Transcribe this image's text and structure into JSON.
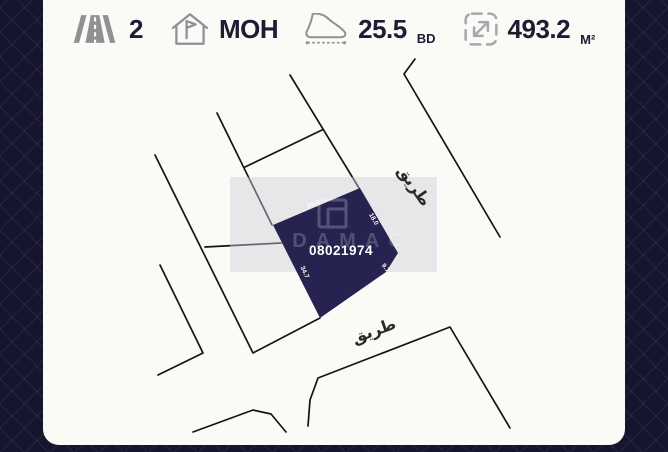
{
  "header": {
    "stats": [
      {
        "id": "roads",
        "icon": "road-icon",
        "value": "2",
        "unit": ""
      },
      {
        "id": "classification",
        "icon": "house-flag-icon",
        "value": "MOH",
        "unit": ""
      },
      {
        "id": "price_per_foot",
        "icon": "foot-measure-icon",
        "value": "25.5",
        "unit": "BD"
      },
      {
        "id": "area",
        "icon": "area-expand-icon",
        "value": "493.2",
        "unit": "M²"
      }
    ]
  },
  "map": {
    "plot_number": "08021974",
    "edge_labels": [
      {
        "text": "20.4",
        "edge": "top-left"
      },
      {
        "text": "18.0",
        "edge": "top-right"
      },
      {
        "text": "9.7",
        "edge": "right"
      },
      {
        "text": "34.7",
        "edge": "left"
      },
      {
        "text": "14.1",
        "edge": "bottom"
      }
    ],
    "road_labels": [
      {
        "text": "طريق",
        "position": "upper-right"
      },
      {
        "text": "طريق",
        "position": "bottom"
      }
    ],
    "watermark": {
      "brand": "DAMAC"
    }
  },
  "colors": {
    "frame_navy": "#16152e",
    "card_bg": "#fbfaf7",
    "plot_fill": "#272351",
    "map_line": "#141414",
    "icon_gray": "#909095",
    "header_text": "#1d1c33"
  }
}
